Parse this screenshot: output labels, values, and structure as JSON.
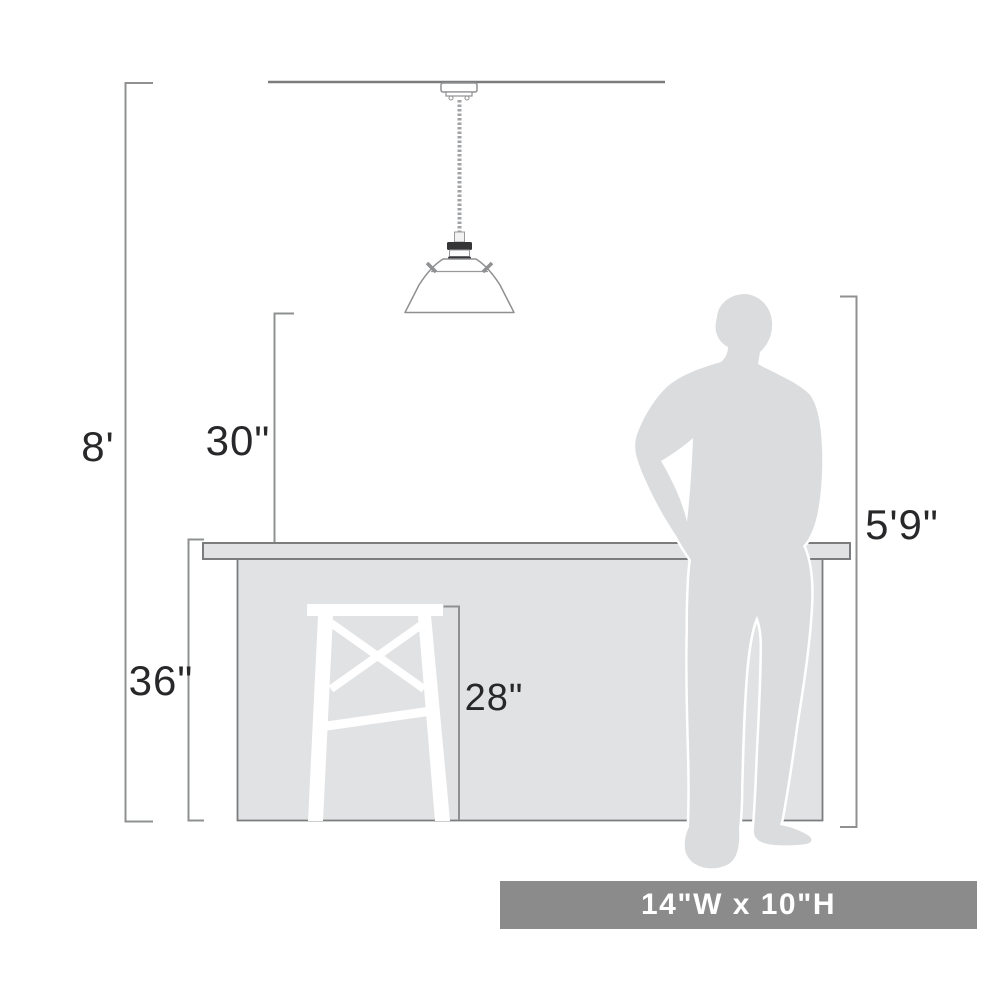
{
  "diagram": {
    "labels": {
      "ceiling_height": "8'",
      "fixture_above_counter": "30\"",
      "counter_height": "36\"",
      "stool_height": "28\"",
      "person_height": "5'9\""
    },
    "banner": {
      "size_label": "14\"W x 10\"H"
    },
    "colors": {
      "silhouette_gray": "#dbdcdd",
      "counter_gray": "#e1e2e3",
      "banner_gray": "#8b8b8b",
      "dimension_line_gray": "#8f9092",
      "outline_gray": "#7b7c7e",
      "text_dark": "#28282a",
      "white": "#ffffff"
    }
  }
}
